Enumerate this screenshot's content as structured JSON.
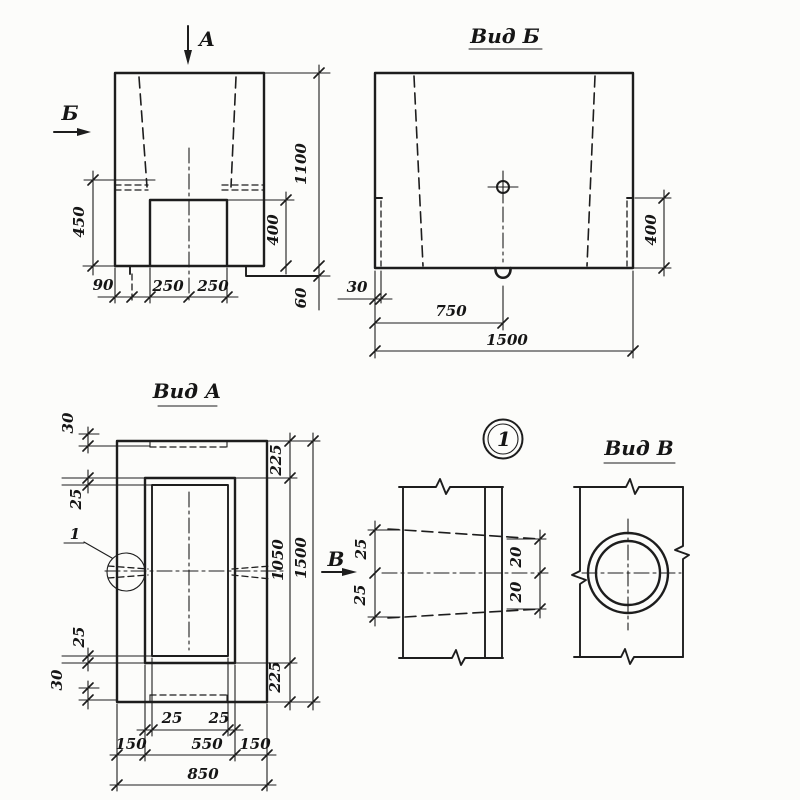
{
  "front_view": {
    "direction_label_a": "А",
    "direction_label_b": "Б",
    "dim_450": "450",
    "dim_1100": "1100",
    "dim_400": "400",
    "dim_90": "90",
    "dim_250_left": "250",
    "dim_250_right": "250",
    "dim_60": "60"
  },
  "view_b": {
    "title": "Вид Б",
    "dim_30": "30",
    "dim_750": "750",
    "dim_1500": "1500",
    "dim_400": "400"
  },
  "view_a": {
    "title": "Вид А",
    "detail_label": "1",
    "direction_label_v": "В",
    "dim_30_top": "30",
    "dim_25_upper": "25",
    "dim_25_lower": "25",
    "dim_30_bottom": "30",
    "dim_225_top": "225",
    "dim_1050": "1050",
    "dim_225_bottom": "225",
    "dim_1500": "1500",
    "dim_25_bottom_left": "25",
    "dim_25_bottom_right": "25",
    "dim_150_left": "150",
    "dim_550": "550",
    "dim_150_right": "150",
    "dim_850": "850"
  },
  "detail_1": {
    "marker": "1",
    "dim_25_top": "25",
    "dim_25_bottom": "25",
    "dim_20_top": "20",
    "dim_20_bottom": "20"
  },
  "view_v": {
    "title": "Вид В"
  }
}
